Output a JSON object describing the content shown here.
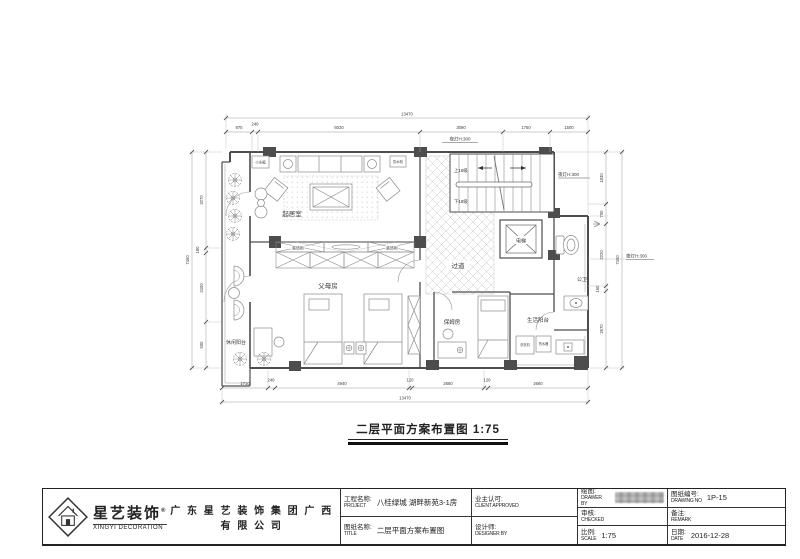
{
  "plan": {
    "title": "二层平面方案布置图 1:75",
    "rooms": {
      "living": "起居室",
      "corridor": "过道",
      "parents": "父母房",
      "nanny": "保姆房",
      "leisure_balcony": "休闲阳台",
      "service_balcony": "生活阳台",
      "elevator": "电梯",
      "bathroom": "公卫"
    },
    "labels": {
      "night_light_top": "夜灯H:300",
      "night_light_right": "夜灯H:300",
      "night_light_side": "夜灯H:300",
      "stairs_up": "上18级",
      "stairs_down": "下18级",
      "fridge": "小冰箱",
      "water_dispenser": "饮水机",
      "cabinet_left": "装饰柜",
      "cabinet_right": "装饰柜",
      "washer": "洗衣机",
      "heater": "热水器"
    },
    "dims": {
      "top_total": "13470",
      "top": [
        "970",
        "240",
        "6020",
        "3090",
        "1750",
        "1500"
      ],
      "bottom": [
        "1710",
        "240",
        "4940",
        "120",
        "2660",
        "120",
        "2680"
      ],
      "bottom_total": "13470",
      "left": [
        "3270",
        "180",
        "2400",
        "500"
      ],
      "left_total": "7460",
      "right": [
        "1830",
        "700",
        "2220",
        "160",
        "2670"
      ],
      "right_total": "7450"
    }
  },
  "titleblock": {
    "brand_cn": "星艺装饰",
    "brand_reg": "®",
    "brand_en": "XINGYI DECORATION",
    "company": "广 东 星 艺 装 饰 集 团 广 西 有 限 公 司",
    "project_label_cn": "工程名称:",
    "project_label_en": "PROJECT",
    "project_value": "八桂绿城 湖畔新苑3-1房",
    "title_label_cn": "图纸名称:",
    "title_label_en": "TITLE",
    "title_value": "二层平面方案布置图",
    "client_label_cn": "业主认可:",
    "client_label_en": "CLIENT APPROVED",
    "designer_label_cn": "设计师:",
    "designer_label_en": "DESIGNER BY",
    "drawer_label_cn": "绘图:",
    "drawer_label_en": "DRAWER BY",
    "checked_label_cn": "审核:",
    "checked_label_en": "CHECKED",
    "scale_label_cn": "比例:",
    "scale_label_en": "SCALE",
    "scale_value": "1:75",
    "dwgno_label_cn": "图纸编号:",
    "dwgno_label_en": "DRAWING NO",
    "dwgno_value": "1P-15",
    "remark_label_cn": "备注:",
    "remark_label_en": "REMARK",
    "date_label_cn": "日期:",
    "date_label_en": "DATE",
    "date_value": "2016-12-28"
  }
}
